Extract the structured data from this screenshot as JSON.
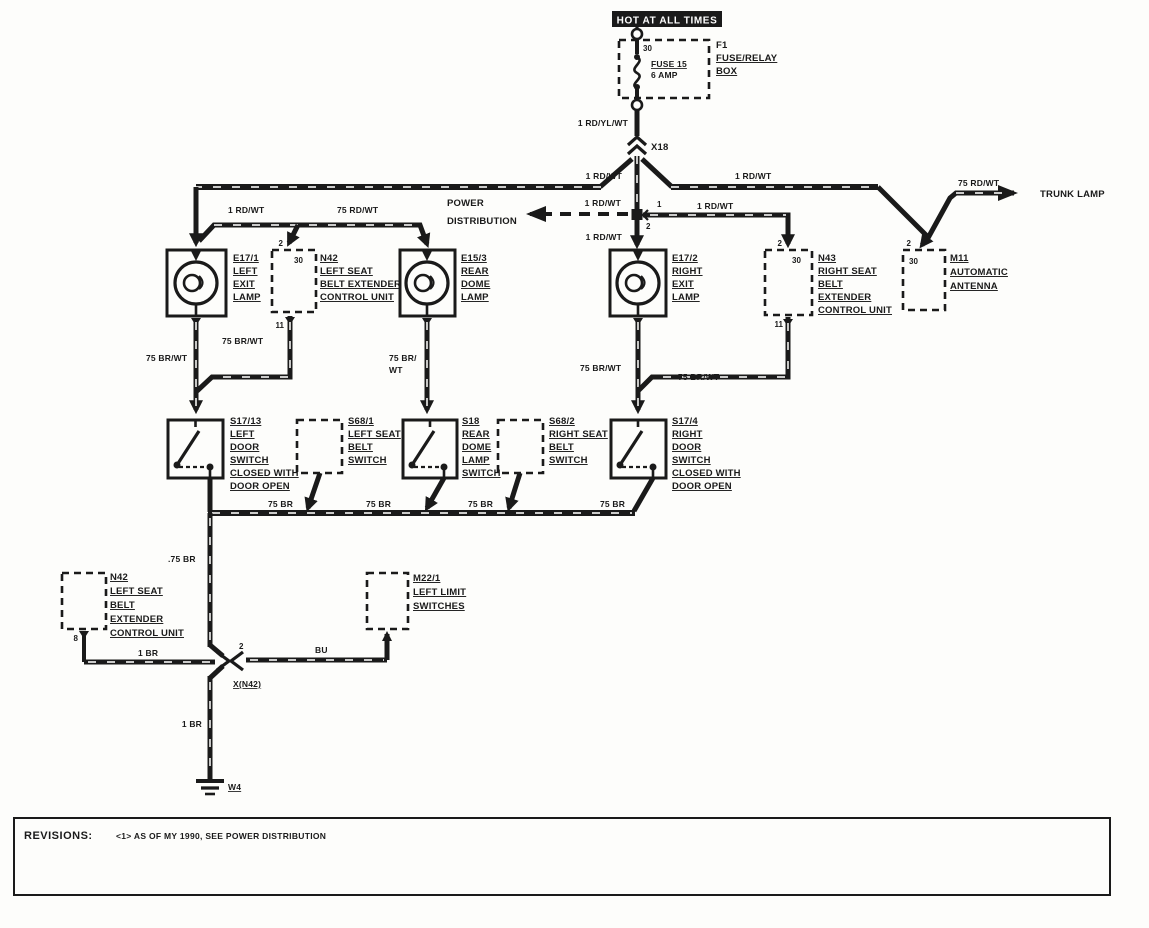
{
  "colors": {
    "ink": "#1a1a1a",
    "paper": "#fdfdfb"
  },
  "power": {
    "banner": "HOT AT ALL TIMES",
    "fuse_pin": "30",
    "fuse_name": "FUSE 15",
    "fuse_rating": "6 AMP",
    "box_id": "F1",
    "box_name_1": "FUSE/RELAY",
    "box_name_2": "BOX"
  },
  "connectors": {
    "x18": "X18",
    "xn42": "X(N42)",
    "xn42_pin": "2",
    "junction_pin_upper": "1",
    "junction_pin_lower": "2"
  },
  "wires": {
    "feed": "1 RD/YL/WT",
    "bus_left": "1 RD/WT",
    "bus_right": "1 RD/WT",
    "trunk": "75 RD/WT",
    "sub_left": "1 RD/WT",
    "sub_right": "75 RD/WT",
    "power_dist": "1 RD/WT",
    "exit_right_feed": "1 RD/WT",
    "n43_feed": "1 RD/WT",
    "left_drop": "75 BR/WT",
    "n42_drop": "75 BR/WT",
    "mid_drop_1": "75 BR/",
    "mid_drop_2": "WT",
    "right_drop": "75 BR/WT",
    "n43_drop": "75 BR/WT",
    "ground_bus_1": "75 BR",
    "ground_bus_2": "75 BR",
    "ground_bus_3": "75 BR",
    "ground_bus_4": "75 BR",
    "down_left": ".75 BR",
    "n42_ground": "1 BR",
    "limit_wire": "BU",
    "main_ground": "1 BR"
  },
  "destinations": {
    "trunk_lamp": "TRUNK LAMP",
    "power_distribution_1": "POWER",
    "power_distribution_2": "DISTRIBUTION"
  },
  "components": {
    "e17_1": {
      "id": "E17/1",
      "lines": [
        "LEFT",
        "EXIT",
        "LAMP"
      ]
    },
    "n42_top": {
      "id": "N42",
      "lines": [
        "LEFT SEAT",
        "BELT EXTENDER",
        "CONTROL UNIT"
      ],
      "pin_in": "2",
      "terminal": "30",
      "pin_out": "11"
    },
    "e15_3": {
      "id": "E15/3",
      "lines": [
        "REAR",
        "DOME",
        "LAMP"
      ]
    },
    "e17_2": {
      "id": "E17/2",
      "lines": [
        "RIGHT",
        "EXIT",
        "LAMP"
      ]
    },
    "n43": {
      "id": "N43",
      "lines": [
        "RIGHT SEAT",
        "BELT",
        "EXTENDER",
        "CONTROL UNIT"
      ],
      "pin_in": "2",
      "terminal": "30",
      "pin_out": "11"
    },
    "m11": {
      "id": "M11",
      "lines": [
        "AUTOMATIC",
        "ANTENNA"
      ],
      "pin_in": "2",
      "terminal": "30"
    },
    "s17_13": {
      "id": "S17/13",
      "lines": [
        "LEFT",
        "DOOR",
        "SWITCH",
        "CLOSED WITH",
        "DOOR OPEN"
      ]
    },
    "s68_1": {
      "id": "S68/1",
      "lines": [
        "LEFT SEAT",
        "BELT",
        "SWITCH"
      ]
    },
    "s18": {
      "id": "S18",
      "lines": [
        "REAR",
        "DOME",
        "LAMP",
        "SWITCH"
      ]
    },
    "s68_2": {
      "id": "S68/2",
      "lines": [
        "RIGHT SEAT",
        "BELT",
        "SWITCH"
      ]
    },
    "s17_4": {
      "id": "S17/4",
      "lines": [
        "RIGHT",
        "DOOR",
        "SWITCH",
        "CLOSED WITH",
        "DOOR OPEN"
      ]
    },
    "n42_bottom": {
      "id": "N42",
      "lines": [
        "LEFT SEAT",
        "BELT",
        "EXTENDER",
        "CONTROL UNIT"
      ],
      "pin_out": "8"
    },
    "m22_1": {
      "id": "M22/1",
      "lines": [
        "LEFT LIMIT",
        "SWITCHES"
      ]
    }
  },
  "ground_point": "W4",
  "revisions": {
    "label": "REVISIONS:",
    "note": "<1> AS OF MY 1990, SEE POWER DISTRIBUTION"
  }
}
